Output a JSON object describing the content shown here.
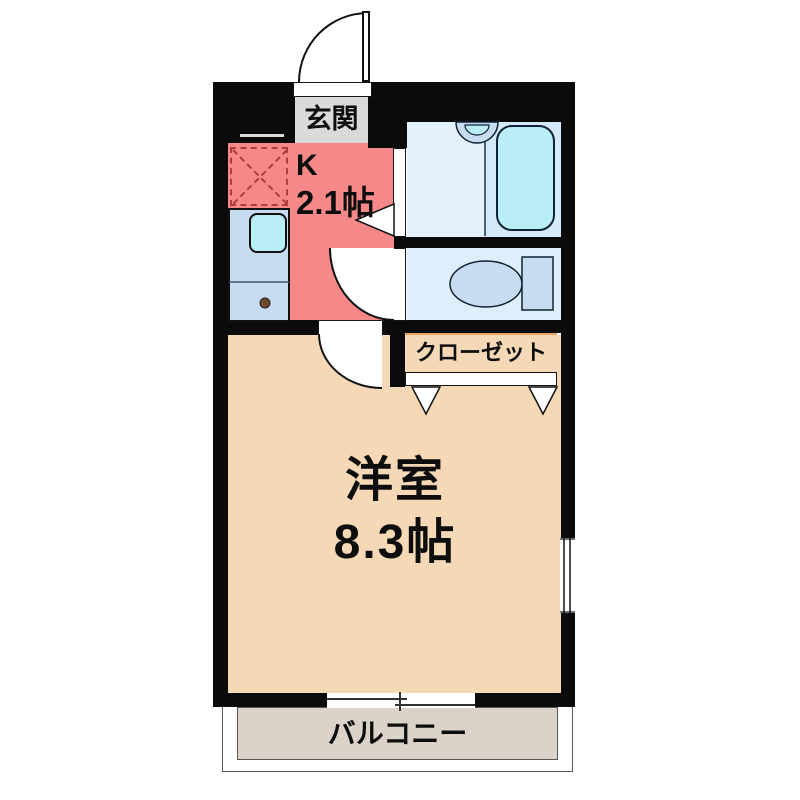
{
  "plan": {
    "rooms": {
      "genkan": {
        "label": "玄関"
      },
      "kitchen": {
        "type_label": "K",
        "size_label": "2.1帖"
      },
      "closet": {
        "label": "クローゼット"
      },
      "main_room": {
        "label": "洋室",
        "size_label": "8.3帖"
      },
      "balcony": {
        "label": "バルコニー"
      }
    },
    "colors": {
      "wall": "#0b0b0b",
      "kitchen": "#f58989",
      "main_room": "#f5d8b6",
      "balcony": "#dbd3ca",
      "bathroom": "#e3f1fc",
      "bathtub": "#b9eef9",
      "toilet_room": "#dfeefb",
      "closet": "#efa55e",
      "entrance": "#dadada",
      "kitchen_counter": "#c7dbf1",
      "sink": "#b9eef9",
      "fridge_outline": "#b23b3b"
    }
  }
}
